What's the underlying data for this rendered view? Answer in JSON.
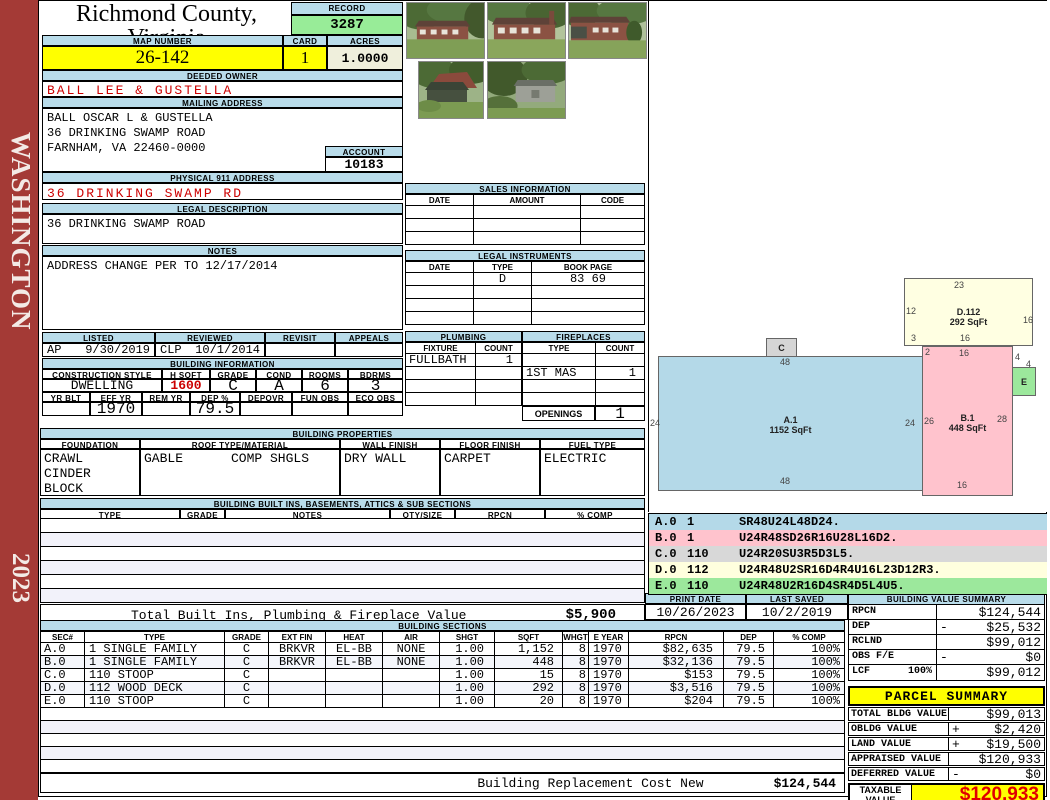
{
  "header": {
    "title": "Richmond County, Virginia",
    "subtitle": "Commissioner of the Revenue, PO Box 366, Warsaw, VA 22572"
  },
  "sidebar": {
    "district": "WASHINGTON",
    "year": "2023"
  },
  "record": {
    "label": "RECORD",
    "value": "3287"
  },
  "map": {
    "label": "MAP NUMBER",
    "value": "26-142"
  },
  "card": {
    "label": "CARD",
    "value": "1"
  },
  "acres": {
    "label": "ACRES",
    "value": "1.0000"
  },
  "deeded_owner": {
    "label": "DEEDED OWNER",
    "value": "BALL LEE & GUSTELLA"
  },
  "mailing": {
    "label": "MAILING ADDRESS",
    "lines": [
      "BALL OSCAR L & GUSTELLA",
      "36 DRINKING SWAMP ROAD",
      "",
      "FARNHAM, VA 22460-0000"
    ]
  },
  "account": {
    "label": "ACCOUNT",
    "value": "10183"
  },
  "physical": {
    "label": "PHYSICAL 911 ADDRESS",
    "value": "36 DRINKING SWAMP RD"
  },
  "legal_description": {
    "label": "LEGAL DESCRIPTION",
    "value": "36 DRINKING SWAMP ROAD"
  },
  "notes": {
    "label": "NOTES",
    "value": "ADDRESS CHANGE PER TO 12/17/2014"
  },
  "listed": {
    "headers": [
      "LISTED",
      "REVIEWED",
      "REVISIT",
      "APPEALS"
    ],
    "values": [
      {
        "code": "AP",
        "date": "9/30/2019"
      },
      {
        "code": "CLP",
        "date": "10/1/2014"
      },
      {
        "code": "",
        "date": ""
      },
      {
        "code": "",
        "date": ""
      }
    ]
  },
  "building_information": {
    "label": "BUILDING INFORMATION",
    "row1_headers": [
      "CONSTRUCTION STYLE",
      "H SQFT",
      "GRADE",
      "COND",
      "ROOMS",
      "BDRMS"
    ],
    "row1_values": [
      "DWELLING",
      "1600",
      "C",
      "A",
      "6",
      "3"
    ],
    "row2_headers": [
      "YR BLT",
      "EFF YR",
      "REM YR",
      "DEP %",
      "DEPOVR",
      "FUN OBS",
      "ECO OBS"
    ],
    "row2_values": [
      "",
      "1970",
      "",
      "79.5",
      "",
      "",
      ""
    ]
  },
  "sales": {
    "label": "SALES INFORMATION",
    "headers": [
      "DATE",
      "AMOUNT",
      "CODE"
    ],
    "rows": [
      [
        "",
        "",
        ""
      ],
      [
        "",
        "",
        ""
      ],
      [
        "",
        "",
        ""
      ]
    ]
  },
  "legal_instruments": {
    "label": "LEGAL INSTRUMENTS",
    "headers": [
      "DATE",
      "TYPE",
      "BOOK PAGE"
    ],
    "rows": [
      [
        "",
        "D",
        "83 69"
      ],
      [
        "",
        "",
        ""
      ],
      [
        "",
        "",
        ""
      ],
      [
        "",
        "",
        ""
      ]
    ]
  },
  "plumbing": {
    "label": "PLUMBING",
    "headers": [
      "FIXTURE",
      "COUNT"
    ],
    "rows": [
      [
        "FULLBATH",
        "1"
      ],
      [
        "",
        ""
      ],
      [
        "",
        ""
      ],
      [
        "",
        ""
      ]
    ]
  },
  "fireplaces": {
    "label": "FIREPLACES",
    "headers": [
      "TYPE",
      "COUNT"
    ],
    "rows": [
      [
        "",
        ""
      ],
      [
        "1ST MAS",
        "1"
      ],
      [
        "",
        ""
      ],
      [
        "",
        ""
      ]
    ],
    "openings_label": "OPENINGS",
    "openings_value": "1"
  },
  "building_properties": {
    "label": "BUILDING PROPERTIES",
    "foundation": {
      "header": "FOUNDATION",
      "line1": "CRAWL",
      "line2": "CINDER BLOCK"
    },
    "roof": {
      "header": "ROOF TYPE/MATERIAL",
      "type": "GABLE",
      "material": "COMP SHGLS"
    },
    "wall": {
      "header": "WALL FINISH",
      "value": "DRY WALL"
    },
    "floor": {
      "header": "FLOOR FINISH",
      "value": "CARPET"
    },
    "fuel": {
      "header": "FUEL TYPE",
      "value": "ELECTRIC"
    }
  },
  "built_ins": {
    "label": "BUILDING BUILT INS, BASEMENTS, ATTICS & SUB SECTIONS",
    "headers": [
      "TYPE",
      "GRADE",
      "NOTES",
      "QTY/SIZE",
      "RPCN",
      "% COMP"
    ],
    "total_label": "Total Built Ins, Plumbing & Fireplace Value",
    "total_value": "$5,900"
  },
  "print_date": {
    "label": "PRINT DATE",
    "value": "10/26/2023"
  },
  "last_saved": {
    "label": "LAST SAVED",
    "value": "10/2/2019"
  },
  "building_value_summary": {
    "label": "BUILDING VALUE SUMMARY",
    "rows": [
      {
        "label": "RPCN",
        "pct": "",
        "op": "",
        "amount": "$124,544"
      },
      {
        "label": "DEP",
        "pct": "",
        "op": "-",
        "amount": "$25,532"
      },
      {
        "label": "RCLND",
        "pct": "",
        "op": "",
        "amount": "$99,012"
      },
      {
        "label": "OBS F/E",
        "pct": "",
        "op": "-",
        "amount": "$0"
      },
      {
        "label": "LCF",
        "pct": "100%",
        "op": "",
        "amount": "$99,012"
      }
    ]
  },
  "parcel_summary": {
    "label": "PARCEL SUMMARY",
    "rows": [
      {
        "label": "TOTAL BLDG VALUE",
        "op": "",
        "amount": "$99,013"
      },
      {
        "label": "OBLDG VALUE",
        "op": "+",
        "amount": "$2,420"
      },
      {
        "label": "LAND VALUE",
        "op": "+",
        "amount": "$19,500"
      },
      {
        "label": "APPRAISED VALUE",
        "op": "",
        "amount": "$120,933"
      },
      {
        "label": "DEFERRED VALUE",
        "op": "-",
        "amount": "$0"
      }
    ],
    "taxable_label": "TAXABLE VALUE",
    "taxable_value": "$120,933"
  },
  "building_sections": {
    "label": "BUILDING SECTIONS",
    "headers": [
      "SEC#",
      "TYPE",
      "GRADE",
      "EXT FIN",
      "HEAT",
      "AIR",
      "SHGT",
      "SQFT",
      "WHGT",
      "E YEAR",
      "RPCN",
      "DEP",
      "% COMP"
    ],
    "rows": [
      [
        "A.0",
        "1 SINGLE FAMILY",
        "C",
        "BRKVR",
        "EL-BB",
        "NONE",
        "1.00",
        "1,152",
        "8",
        "1970",
        "$82,635",
        "79.5",
        "100%"
      ],
      [
        "B.0",
        "1 SINGLE FAMILY",
        "C",
        "BRKVR",
        "EL-BB",
        "NONE",
        "1.00",
        "448",
        "8",
        "1970",
        "$32,136",
        "79.5",
        "100%"
      ],
      [
        "C.0",
        "110 STOOP",
        "C",
        "",
        "",
        "",
        "1.00",
        "15",
        "8",
        "1970",
        "$153",
        "79.5",
        "100%"
      ],
      [
        "D.0",
        "112 WOOD DECK",
        "C",
        "",
        "",
        "",
        "1.00",
        "292",
        "8",
        "1970",
        "$3,516",
        "79.5",
        "100%"
      ],
      [
        "E.0",
        "110 STOOP",
        "C",
        "",
        "",
        "",
        "1.00",
        "20",
        "8",
        "1970",
        "$204",
        "79.5",
        "100%"
      ]
    ],
    "note_label": "Building Replacement Cost New",
    "note_value": "$124,544"
  },
  "sketch": {
    "shapes": {
      "A": {
        "label": "A.1",
        "sqft": "1152 SqFt",
        "top": "48",
        "left": "24",
        "right": "24",
        "bottom": "48",
        "color": "#B4D9E8"
      },
      "B": {
        "label": "B.1",
        "sqft": "448 SqFt",
        "topleft": "2",
        "top": "16",
        "left": "26",
        "right": "28",
        "bottom": "16",
        "color": "#FFC3CD"
      },
      "C": {
        "label": "C",
        "color": "#D5D5D5"
      },
      "D": {
        "label": "D.112",
        "sqft": "292 SqFt",
        "top": "23",
        "left": "12",
        "right": "16",
        "bottom_left": "3",
        "bottom": "16",
        "color": "#FFFFE2"
      },
      "E": {
        "label": "E",
        "dim1": "4",
        "dim2": "4",
        "color": "#9CE89C"
      }
    },
    "legend": [
      {
        "sec": "A.0",
        "mult": "1",
        "code": "SR48U24L48D24.",
        "color": "#B4D9E8"
      },
      {
        "sec": "B.0",
        "mult": "1",
        "code": "U24R48SD26R16U28L16D2.",
        "color": "#FFC3CD"
      },
      {
        "sec": "C.0",
        "mult": "110",
        "code": "U24R20SU3R5D3L5.",
        "color": "#D8D8D8"
      },
      {
        "sec": "D.0",
        "mult": "112",
        "code": "U24R48U2SR16D4R4U16L23D12R3.",
        "color": "#FFFFDE"
      },
      {
        "sec": "E.0",
        "mult": "110",
        "code": "U24R48U2R16D4SR4D5L4U5.",
        "color": "#9CE89C"
      }
    ]
  },
  "colors": {
    "header_bar": "#B9DCEA",
    "highlight": "#FFFF00",
    "record_value_bg": "#98EC98",
    "acres_bg": "#EFEFDC",
    "alert_text": "#CC0000",
    "sidebar_bg": "#A43A36",
    "taxable_text": "#E00000",
    "parcel_header_bg": "#FFFF00"
  }
}
